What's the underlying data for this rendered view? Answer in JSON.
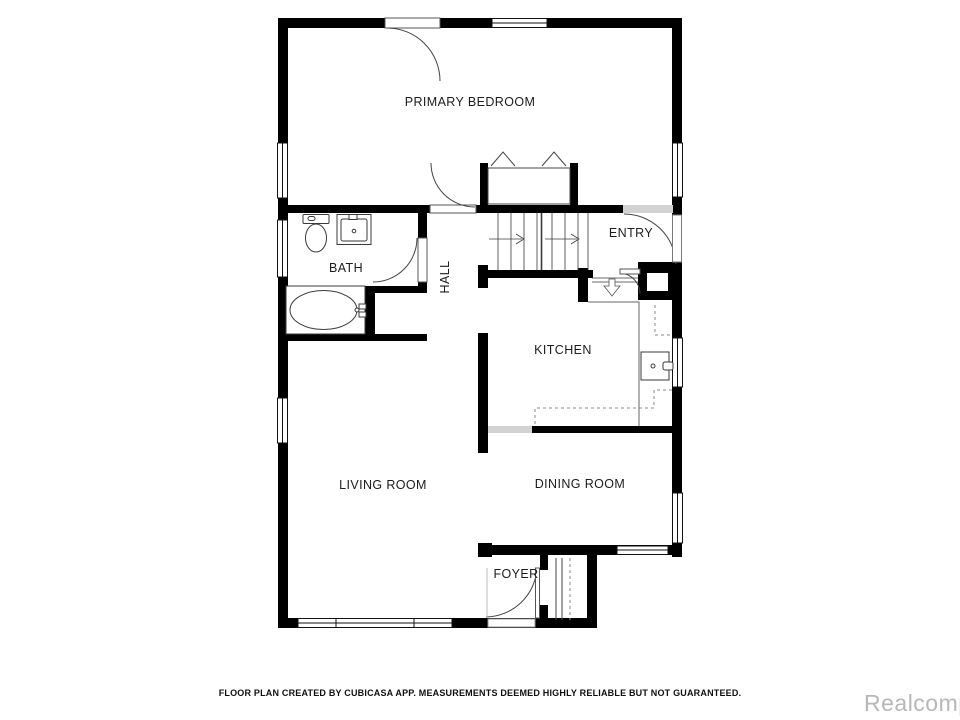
{
  "plan": {
    "title": "Residential floor plan, main level",
    "creator_app": "CubiCasa",
    "rooms": [
      {
        "id": "primary-bedroom",
        "label": "PRIMARY BEDROOM"
      },
      {
        "id": "bath",
        "label": "BATH"
      },
      {
        "id": "hall",
        "label": "HALL"
      },
      {
        "id": "entry",
        "label": "ENTRY"
      },
      {
        "id": "kitchen",
        "label": "KITCHEN"
      },
      {
        "id": "living-room",
        "label": "LIVING ROOM"
      },
      {
        "id": "dining-room",
        "label": "DINING ROOM"
      },
      {
        "id": "foyer",
        "label": "FOYER"
      }
    ],
    "fixtures": [
      "toilet",
      "bathroom-sink",
      "bathtub",
      "kitchen-sink",
      "closet-hanger-chevrons",
      "stair-up-arrows",
      "stair-down-arrow",
      "chimney",
      "porch-steps",
      "counter-dashed-outline",
      "doors-with-swing-arcs",
      "windows"
    ],
    "colors": {
      "wall": "#000000",
      "fixture_line": "#3a3a3a",
      "dashed_counter": "#8a8a8a",
      "opening_threshold": "#d2d2d2",
      "label_text": "#1c1c1c",
      "footer_text": "#101010",
      "watermark_text": "#b7b7b7",
      "background": "#ffffff"
    }
  },
  "footer": {
    "disclaimer": "FLOOR PLAN CREATED BY CUBICASA APP. MEASUREMENTS DEEMED HIGHLY RELIABLE BUT NOT GUARANTEED.",
    "watermark": "Realcomp"
  }
}
